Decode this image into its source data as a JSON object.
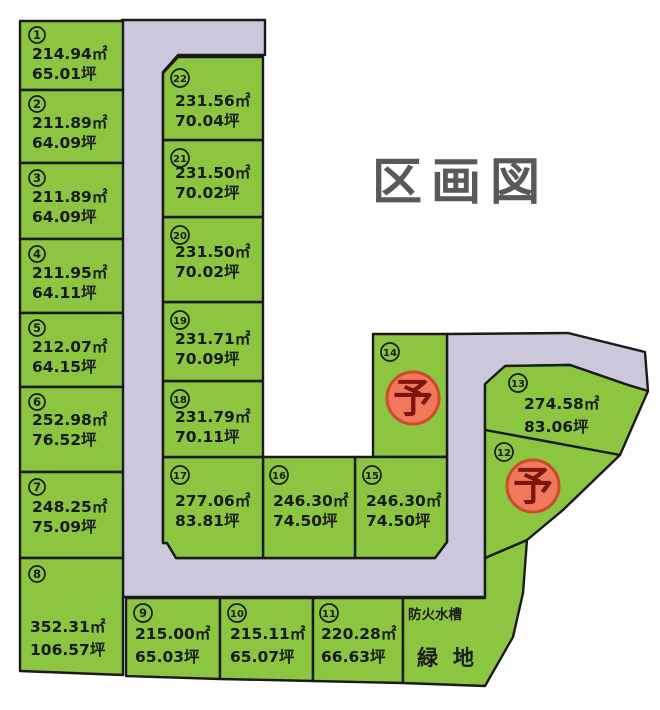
{
  "title": "区画図",
  "reserve_label": "予",
  "labels": {
    "fire_water_tank": "防火水槽",
    "green_space": "緑地"
  },
  "colors": {
    "plot_fill": "#8CC540",
    "road_fill": "#CAC8DA",
    "line": "#1A1A1A",
    "title_color": "#58595B",
    "reserved_fill": "#F1785A",
    "reserved_border": "#CC4B28",
    "reserved_glyph": "#7A150F"
  },
  "plots": [
    {
      "no": "1",
      "m2": "214.94㎡",
      "tsubo": "65.01坪"
    },
    {
      "no": "2",
      "m2": "211.89㎡",
      "tsubo": "64.09坪"
    },
    {
      "no": "3",
      "m2": "211.89㎡",
      "tsubo": "64.09坪"
    },
    {
      "no": "4",
      "m2": "211.95㎡",
      "tsubo": "64.11坪"
    },
    {
      "no": "5",
      "m2": "212.07㎡",
      "tsubo": "64.15坪"
    },
    {
      "no": "6",
      "m2": "252.98㎡",
      "tsubo": "76.52坪"
    },
    {
      "no": "7",
      "m2": "248.25㎡",
      "tsubo": "75.09坪"
    },
    {
      "no": "8",
      "m2": "352.31㎡",
      "tsubo": "106.57坪"
    },
    {
      "no": "9",
      "m2": "215.00㎡",
      "tsubo": "65.03坪"
    },
    {
      "no": "10",
      "m2": "215.11㎡",
      "tsubo": "65.07坪"
    },
    {
      "no": "11",
      "m2": "220.28㎡",
      "tsubo": "66.63坪"
    },
    {
      "no": "12",
      "status": "予"
    },
    {
      "no": "13",
      "m2": "274.58㎡",
      "tsubo": "83.06坪"
    },
    {
      "no": "14",
      "status": "予"
    },
    {
      "no": "15",
      "m2": "246.30㎡",
      "tsubo": "74.50坪"
    },
    {
      "no": "16",
      "m2": "246.30㎡",
      "tsubo": "74.50坪"
    },
    {
      "no": "17",
      "m2": "277.06㎡",
      "tsubo": "83.81坪"
    },
    {
      "no": "18",
      "m2": "231.79㎡",
      "tsubo": "70.11坪"
    },
    {
      "no": "19",
      "m2": "231.71㎡",
      "tsubo": "70.09坪"
    },
    {
      "no": "20",
      "m2": "231.50㎡",
      "tsubo": "70.02坪"
    },
    {
      "no": "21",
      "m2": "231.50㎡",
      "tsubo": "70.02坪"
    },
    {
      "no": "22",
      "m2": "231.56㎡",
      "tsubo": "70.04坪"
    }
  ]
}
